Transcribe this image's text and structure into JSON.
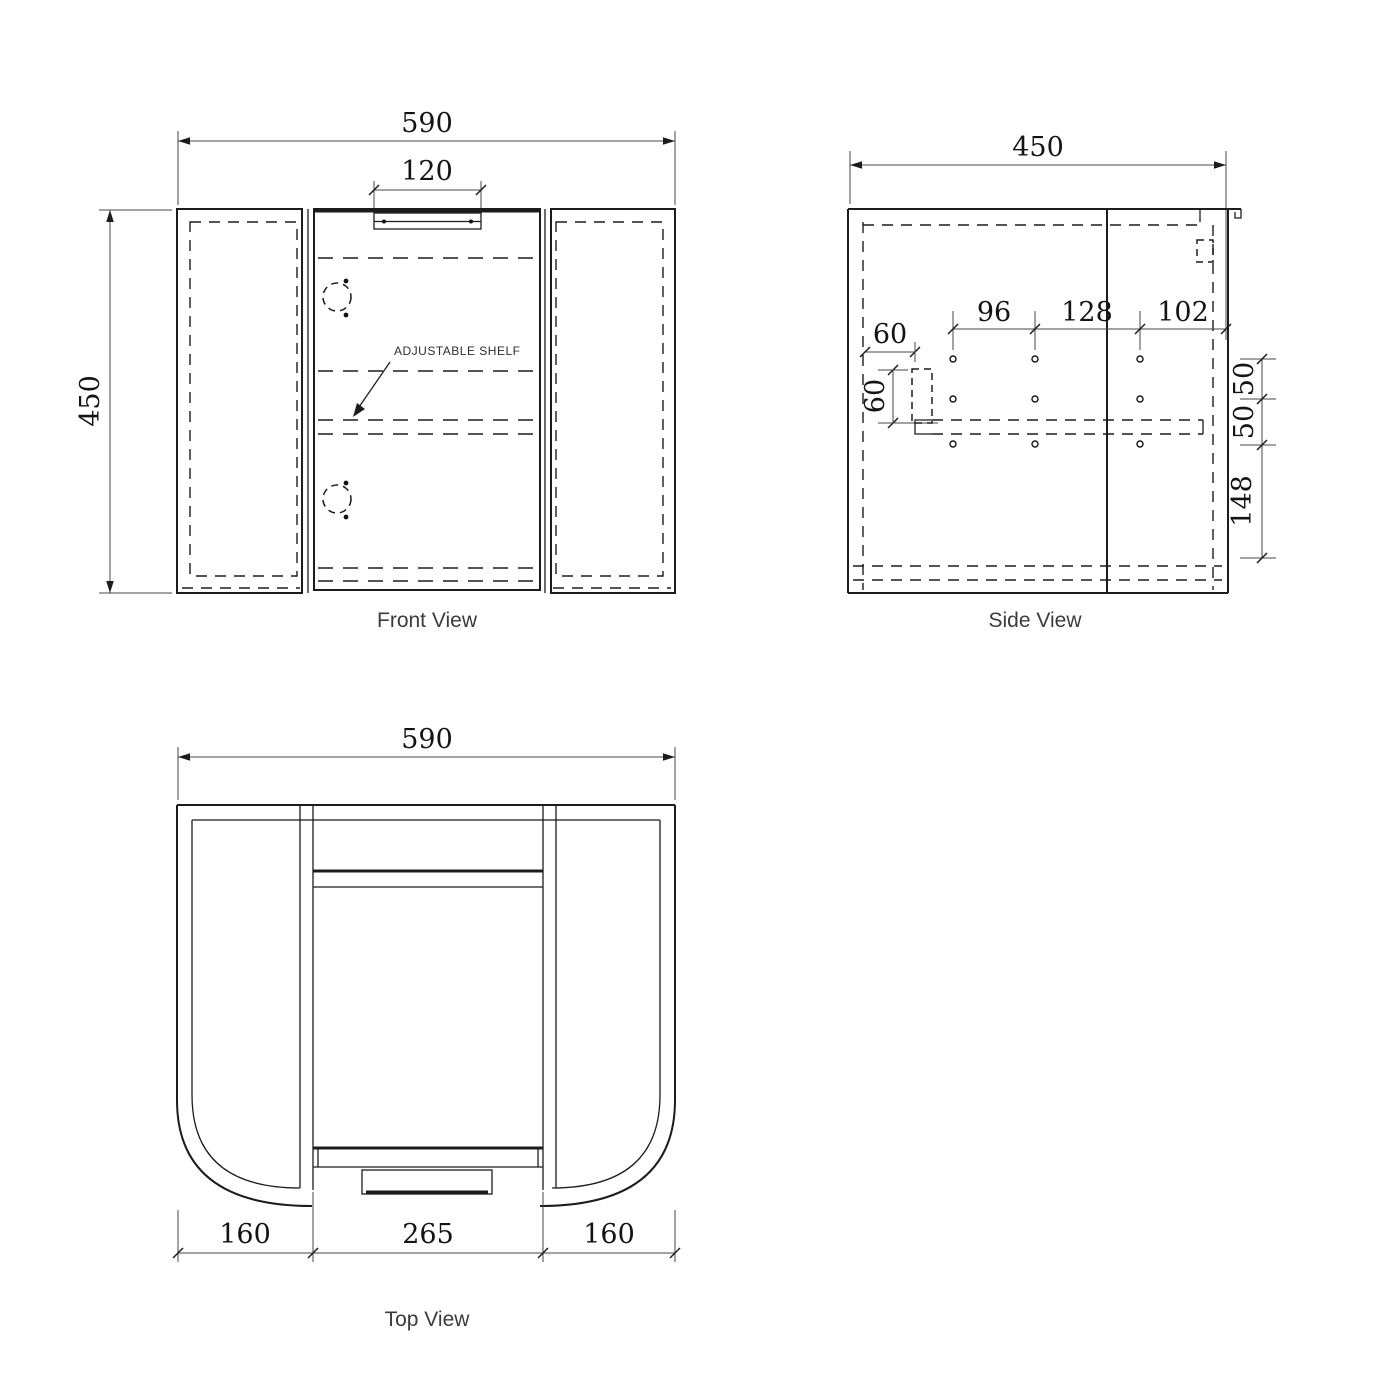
{
  "colors": {
    "object_line": "#1c1c1c",
    "dim_line": "#474747",
    "text": "#141414",
    "background": "#ffffff"
  },
  "front_view": {
    "title": "Front View",
    "overall_width": "590",
    "handle_width": "120",
    "overall_height": "450",
    "shelf_label": "ADJUSTABLE SHELF"
  },
  "side_view": {
    "title": "Side View",
    "overall_depth": "450",
    "hole_pitch_1": "96",
    "hole_pitch_2": "128",
    "hole_edge_gap": "102",
    "offset_horizontal": "60",
    "offset_vertical": "60",
    "row_gap_top": "50",
    "row_gap_mid": "50",
    "bottom_offset": "148"
  },
  "top_view": {
    "title": "Top View",
    "overall_width": "590",
    "left_wing_depth": "160",
    "door_width": "265",
    "right_wing_depth": "160"
  }
}
